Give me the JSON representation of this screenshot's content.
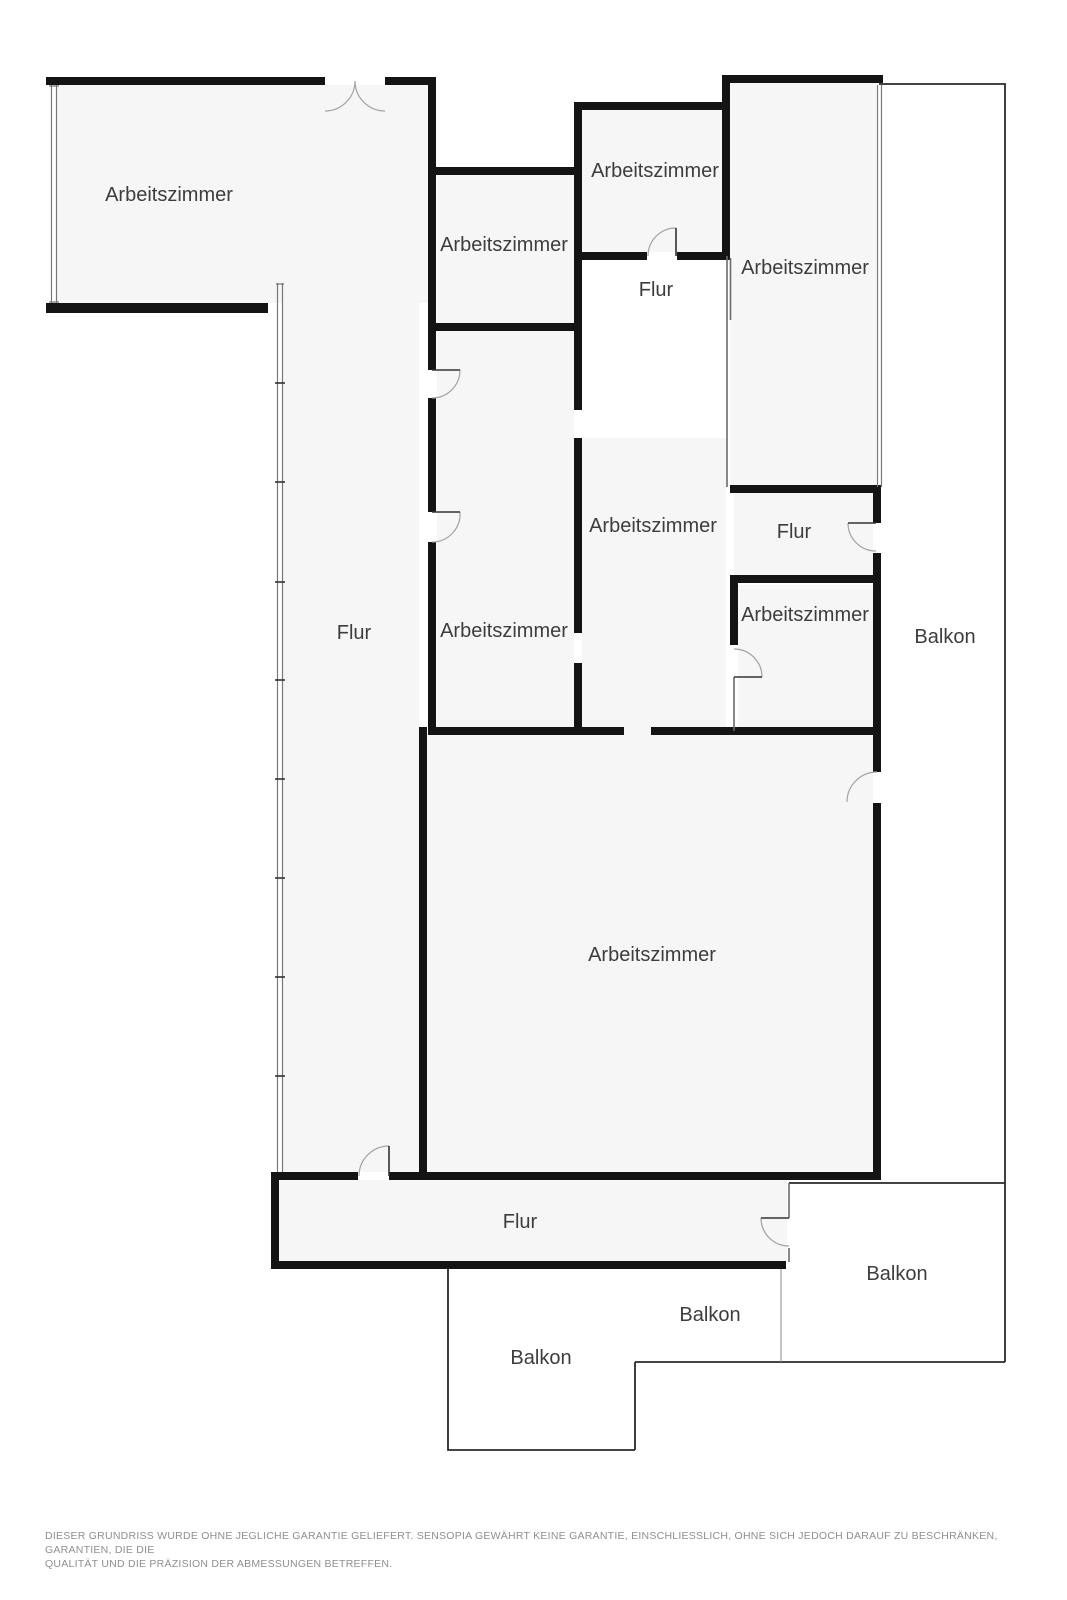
{
  "floorplan": {
    "rooms": [
      {
        "id": "arbeitszimmer-top-left",
        "label": "Arbeitszimmer",
        "x": 169,
        "y": 195
      },
      {
        "id": "arbeitszimmer-upper-mid",
        "label": "Arbeitszimmer",
        "x": 504,
        "y": 245
      },
      {
        "id": "arbeitszimmer-top",
        "label": "Arbeitszimmer",
        "x": 655,
        "y": 171
      },
      {
        "id": "flur-top",
        "label": "Flur",
        "x": 656,
        "y": 290
      },
      {
        "id": "arbeitszimmer-right",
        "label": "Arbeitszimmer",
        "x": 805,
        "y": 268
      },
      {
        "id": "arbeitszimmer-mid-left",
        "label": "Arbeitszimmer",
        "x": 504,
        "y": 631
      },
      {
        "id": "arbeitszimmer-mid",
        "label": "Arbeitszimmer",
        "x": 653,
        "y": 526
      },
      {
        "id": "flur-right",
        "label": "Flur",
        "x": 794,
        "y": 532
      },
      {
        "id": "arbeitszimmer-small-right",
        "label": "Arbeitszimmer",
        "x": 805,
        "y": 615
      },
      {
        "id": "balkon-right-strip",
        "label": "Balkon",
        "x": 945,
        "y": 637
      },
      {
        "id": "flur-left",
        "label": "Flur",
        "x": 354,
        "y": 633
      },
      {
        "id": "arbeitszimmer-big",
        "label": "Arbeitszimmer",
        "x": 652,
        "y": 955
      },
      {
        "id": "flur-bottom",
        "label": "Flur",
        "x": 520,
        "y": 1222
      },
      {
        "id": "balkon-bottom-right",
        "label": "Balkon",
        "x": 897,
        "y": 1274
      },
      {
        "id": "balkon-bottom-mid",
        "label": "Balkon",
        "x": 710,
        "y": 1315
      },
      {
        "id": "balkon-bottom-left",
        "label": "Balkon",
        "x": 541,
        "y": 1358
      }
    ],
    "label_font_size": 20,
    "disclaimer": {
      "line1": "DIESER GRUNDRISS WURDE OHNE JEGLICHE GARANTIE GELIEFERT. SENSOPIA GEWÄHRT KEINE GARANTIE, EINSCHLIESSLICH, OHNE SICH JEDOCH DARAUF ZU BESCHRÄNKEN, GARANTIEN, DIE DIE",
      "line2": "QUALITÄT UND DIE PRÄZISION DER ABMESSUNGEN BETREFFEN."
    },
    "colors": {
      "wall": "#141414",
      "room_fill": "#f6f6f6",
      "thin_line": "#2a2a2a",
      "door_arc": "#a3a3a3",
      "label_text": "#3d3d3d",
      "disclaimer_text": "#8f8f8f",
      "background": "#ffffff"
    }
  }
}
